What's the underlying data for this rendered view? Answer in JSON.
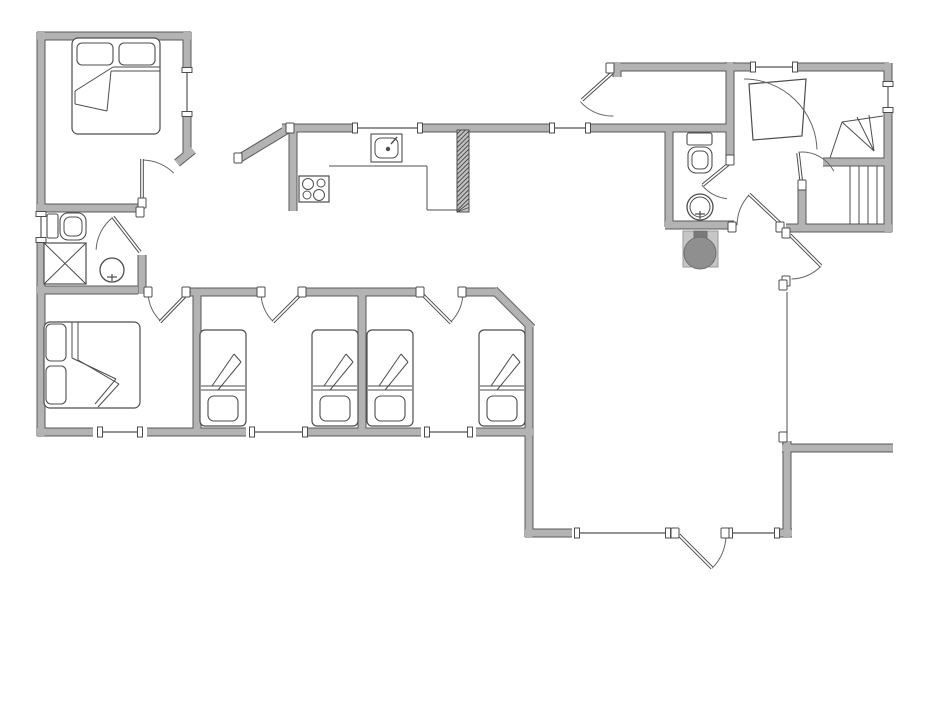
{
  "palette": {
    "wall_fill": "#b3b3b3",
    "wall_stroke": "#5a5a5a",
    "line": "#4d4d4d",
    "thin_line": "#707070",
    "furniture_fill": "#ffffff",
    "boiler_box": "#c6c6c6",
    "boiler_circle": "#8f8f8f",
    "boiler_stub": "#7a7a7a",
    "chimney_fill": "#c2c2c2"
  },
  "canvas": {
    "width": 950,
    "height": 713
  },
  "plan": {
    "wall_thickness": 8,
    "walls": [
      [
        37,
        36,
        191,
        36
      ],
      [
        41,
        32,
        41,
        214
      ],
      [
        41,
        240,
        41,
        436
      ],
      [
        187,
        32,
        187,
        70
      ],
      [
        187,
        114,
        187,
        156
      ],
      [
        177,
        163,
        193,
        150
      ],
      [
        37,
        208,
        144,
        208
      ],
      [
        37,
        290,
        138,
        290
      ],
      [
        142,
        255,
        142,
        294
      ],
      [
        186,
        292,
        261,
        292
      ],
      [
        302,
        292,
        419,
        292
      ],
      [
        462,
        292,
        497,
        292
      ],
      [
        494,
        290,
        532,
        328
      ],
      [
        529,
        326,
        529,
        537
      ],
      [
        197,
        294,
        197,
        432
      ],
      [
        362,
        294,
        362,
        432
      ],
      [
        37,
        432,
        93,
        432
      ],
      [
        147,
        432,
        246,
        432
      ],
      [
        306,
        432,
        421,
        432
      ],
      [
        476,
        432,
        533,
        432
      ],
      [
        525,
        533,
        572,
        533
      ],
      [
        775,
        533,
        792,
        533
      ],
      [
        787,
        441,
        787,
        537
      ],
      [
        782,
        448,
        893,
        448
      ],
      [
        282,
        128,
        353,
        128
      ],
      [
        423,
        128,
        551,
        128
      ],
      [
        591,
        128,
        729,
        128
      ],
      [
        240,
        158,
        288,
        129
      ],
      [
        293,
        126,
        293,
        211
      ],
      [
        612,
        67,
        754,
        67
      ],
      [
        617,
        63,
        617,
        77
      ],
      [
        730,
        62,
        730,
        163
      ],
      [
        795,
        67,
        889,
        67
      ],
      [
        888,
        63,
        888,
        84
      ],
      [
        888,
        110,
        888,
        232
      ],
      [
        786,
        228,
        892,
        228
      ],
      [
        669,
        131,
        669,
        227
      ],
      [
        665,
        225,
        734,
        225
      ],
      [
        802,
        186,
        802,
        230
      ],
      [
        823,
        162,
        886,
        162
      ]
    ],
    "windows": [
      [
        187,
        70,
        187,
        114
      ],
      [
        41,
        214,
        41,
        240
      ],
      [
        100,
        432,
        140,
        432
      ],
      [
        252,
        432,
        305,
        432
      ],
      [
        427,
        432,
        470,
        432
      ],
      [
        355,
        128,
        420,
        128
      ],
      [
        552,
        128,
        588,
        128
      ],
      [
        753,
        67,
        795,
        67
      ],
      [
        888,
        84,
        888,
        110
      ],
      [
        577,
        533,
        668,
        533
      ],
      [
        730,
        533,
        777,
        533
      ]
    ],
    "doors": [
      {
        "leaf": [
          142,
          205,
          142,
          159
        ],
        "arc": [
          142,
          205,
          45,
          -90,
          -45
        ],
        "posts": [
          [
            142,
            203
          ]
        ]
      },
      {
        "leaf": [
          140,
          252,
          113,
          217
        ],
        "arc": [
          140,
          252,
          44,
          -128,
          -177
        ],
        "posts": [
          [
            140,
            212
          ]
        ]
      },
      {
        "leaf": [
          190,
          291,
          160,
          322
        ],
        "arc": [
          190,
          291,
          42,
          134,
          178
        ],
        "posts": [
          [
            186,
            292
          ],
          [
            148,
            292
          ]
        ]
      },
      {
        "leaf": [
          303,
          292,
          273,
          322
        ],
        "arc": [
          303,
          292,
          42,
          135,
          179
        ],
        "posts": [
          [
            302,
            292
          ],
          [
            261,
            292
          ]
        ]
      },
      {
        "leaf": [
          420,
          292,
          451,
          323
        ],
        "arc": [
          420,
          292,
          43,
          45,
          1
        ],
        "posts": [
          [
            420,
            292
          ],
          [
            462,
            292
          ]
        ]
      },
      {
        "leaf": [
          679,
          535,
          712,
          568
        ],
        "arc": [
          679,
          535,
          47,
          45,
          1
        ],
        "posts": [
          [
            675,
            533
          ],
          [
            725,
            533
          ]
        ]
      },
      {
        "leaf": [
          612,
          73,
          582,
          100
        ],
        "arc": [
          612,
          74,
          42,
          139,
          88
        ],
        "posts": [
          [
            610,
            68
          ]
        ]
      },
      {
        "leaf": [
          731,
          162,
          703,
          185
        ],
        "arc": [
          731,
          162,
          37,
          142,
          96
        ],
        "posts": [
          [
            730,
            160
          ]
        ]
      },
      {
        "leaf": [
          802,
          188,
          798,
          153
        ],
        "arc": [
          802,
          188,
          36,
          -96,
          -28
        ],
        "posts": [
          [
            802,
            185
          ]
        ]
      },
      {
        "leaf": [
          783,
          226,
          749,
          194
        ],
        "arc": [
          783,
          226,
          46,
          -137,
          -179
        ],
        "posts": [
          [
            780,
            227
          ],
          [
            732,
            227
          ]
        ]
      },
      {
        "leaf": [
          790,
          235,
          821,
          266
        ],
        "arc": [
          790,
          235,
          44,
          45,
          88
        ],
        "posts": [
          [
            786,
            233
          ],
          [
            786,
            281
          ]
        ]
      },
      {
        "leaf": null,
        "arc": [
          744,
          152,
          73,
          -90,
          -2
        ],
        "posts": []
      }
    ],
    "posts": [
      [
        783,
        285
      ],
      [
        783,
        437
      ],
      [
        238,
        158
      ],
      [
        290,
        128
      ]
    ],
    "thin_lines": [
      [
        329,
        166,
        427,
        166
      ],
      [
        427,
        166,
        427,
        210
      ],
      [
        427,
        210,
        458,
        210
      ],
      [
        787,
        292,
        787,
        441
      ]
    ],
    "stairs": {
      "treads": [
        [
          850,
          166,
          850,
          224
        ],
        [
          859,
          166,
          859,
          224
        ],
        [
          868,
          166,
          868,
          224
        ],
        [
          877,
          166,
          877,
          224
        ]
      ],
      "fan": [
        [
          842,
          122,
          883,
          116
        ],
        [
          842,
          122,
          830,
          158
        ],
        [
          874,
          151,
          842,
          122
        ],
        [
          874,
          151,
          857,
          117
        ],
        [
          874,
          151,
          869,
          115
        ]
      ]
    },
    "chimney": [
      457,
      130,
      12,
      82
    ],
    "closet_polygon": [
      [
        749,
        84
      ],
      [
        806,
        79
      ],
      [
        802,
        136
      ],
      [
        753,
        140
      ]
    ],
    "furniture": {
      "double_beds": [
        {
          "outline": [
            72,
            38,
            88,
            96
          ],
          "pillows": [
            [
              77,
              43,
              36,
              22
            ],
            [
              119,
              43,
              36,
              22
            ]
          ],
          "lines": [
            [
              113,
              67,
              160,
              67
            ],
            [
              111,
              71,
              160,
              71
            ],
            [
              113,
              67,
              75,
              91
            ],
            [
              75,
              91,
              75,
              104
            ],
            [
              75,
              104,
              107,
              111
            ],
            [
              107,
              111,
              111,
              71
            ]
          ]
        },
        {
          "outline": [
            44,
            322,
            96,
            86
          ],
          "pillows": [
            [
              46,
              324,
              20,
              37
            ],
            [
              46,
              366,
              20,
              38
            ]
          ],
          "lines": [
            [
              72,
              322,
              72,
              358
            ],
            [
              78,
              322,
              78,
              360
            ],
            [
              72,
              358,
              116,
              379
            ],
            [
              78,
              360,
              119,
              384
            ],
            [
              119,
              384,
              98,
              407
            ],
            [
              116,
              379,
              95,
              404
            ]
          ]
        }
      ],
      "single_beds": [
        {
          "x": 200,
          "y": 330
        },
        {
          "x": 312,
          "y": 330
        },
        {
          "x": 367,
          "y": 330
        },
        {
          "x": 479,
          "y": 330
        }
      ],
      "single_bed_template": {
        "w": 46,
        "h": 96,
        "pillow": [
          8,
          66,
          30,
          25
        ],
        "lines": [
          [
            1,
            56,
            45,
            56
          ],
          [
            1,
            60,
            45,
            60
          ],
          [
            12,
            56,
            34,
            24
          ],
          [
            34,
            24,
            41,
            32
          ],
          [
            41,
            32,
            18,
            60
          ]
        ]
      },
      "toilets": [
        {
          "tank": [
            47,
            214,
            11,
            24
          ],
          "bowl": [
            60,
            213,
            26,
            27
          ],
          "inner": [
            64,
            217,
            18,
            19
          ]
        },
        {
          "tank": [
            687,
            133,
            25,
            12
          ],
          "bowl": [
            688,
            147,
            24,
            26
          ],
          "inner": [
            692,
            151,
            16,
            18
          ]
        }
      ],
      "shower": {
        "rect": [
          44,
          243,
          42,
          41
        ]
      },
      "basins": [
        {
          "cx": 112,
          "cy": 270,
          "r": 12,
          "double_ring": false
        },
        {
          "cx": 700,
          "cy": 207,
          "r": 13,
          "double_ring": true
        }
      ],
      "kitchen": {
        "stove": [
          299,
          176,
          30,
          26
        ],
        "burners": [
          [
            308,
            184,
            5.5
          ],
          [
            321,
            183,
            4
          ],
          [
            307,
            195,
            4
          ],
          [
            319,
            195,
            5.5
          ]
        ],
        "sink": [
          371,
          134,
          31,
          28
        ],
        "sink_inner": [
          375,
          138,
          23,
          20
        ],
        "faucet_dot": [
          388,
          149
        ],
        "faucet_lever": [
          391,
          144,
          397,
          137
        ]
      },
      "boiler": {
        "box": [
          683,
          231,
          35,
          36
        ],
        "stub": [
          694,
          231,
          13,
          12
        ],
        "circle": [
          700,
          253,
          16
        ]
      }
    }
  }
}
